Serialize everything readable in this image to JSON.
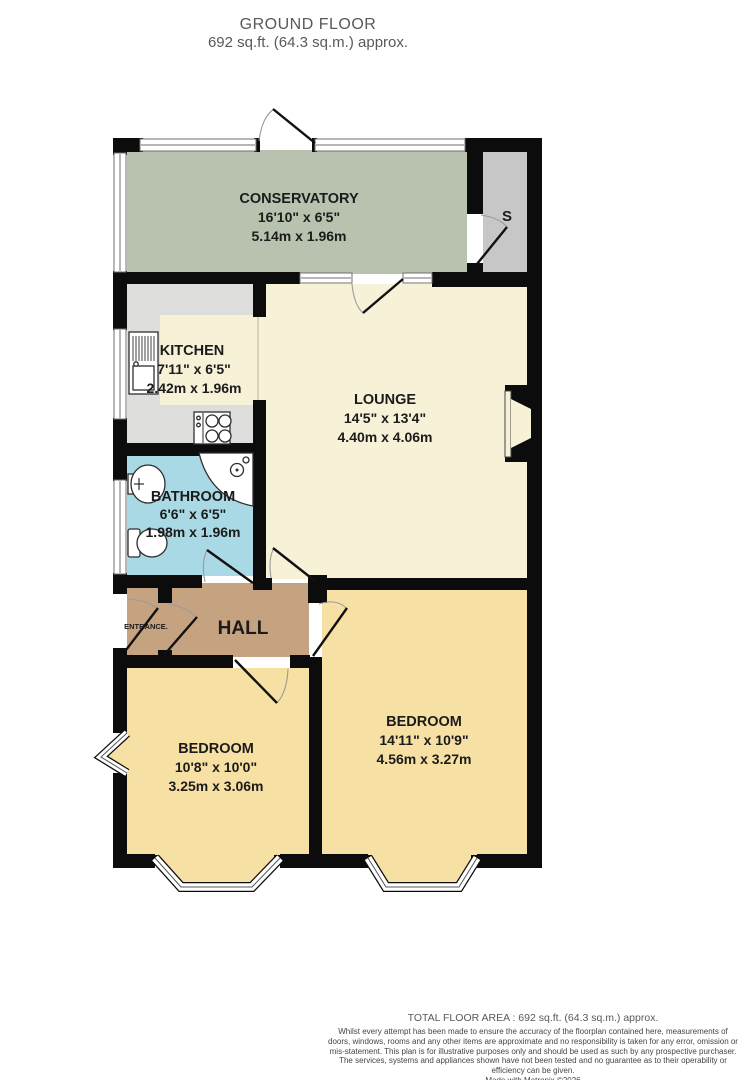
{
  "header": {
    "title": "GROUND FLOOR",
    "subtitle": "692 sq.ft. (64.3 sq.m.) approx."
  },
  "rooms": {
    "conservatory": {
      "name": "CONSERVATORY",
      "imperial": "16'10\" x 6'5\"",
      "metric": "5.14m x 1.96m",
      "color": "#b9c2ae"
    },
    "kitchen": {
      "name": "KITCHEN",
      "imperial": "7'11\" x 6'5\"",
      "metric": "2.42m x 1.96m",
      "color": "#dededd",
      "worktop_color": "#f6f1d7"
    },
    "lounge": {
      "name": "LOUNGE",
      "imperial": "14'5\" x 13'4\"",
      "metric": "4.40m x 4.06m",
      "color": "#f6f1d7"
    },
    "bathroom": {
      "name": "BATHROOM",
      "imperial": "6'6\" x 6'5\"",
      "metric": "1.98m x 1.96m",
      "color": "#aad9e6"
    },
    "hall": {
      "name": "HALL",
      "color": "#c6a380"
    },
    "entrance": {
      "name": "ENTRANCE.",
      "color": "#c6a380"
    },
    "storage": {
      "name": "S",
      "color": "#c7c7c7"
    },
    "bedroom_left": {
      "name": "BEDROOM",
      "imperial": "10'8\" x 10'0\"",
      "metric": "3.25m x 3.06m",
      "color": "#f7e0a3"
    },
    "bedroom_right": {
      "name": "BEDROOM",
      "imperial": "14'11\" x 10'9\"",
      "metric": "4.56m x 3.27m",
      "color": "#f7e0a3"
    }
  },
  "footer": {
    "area_line": "TOTAL FLOOR AREA : 692 sq.ft. (64.3 sq.m.) approx.",
    "disclaimer": "Whilst every attempt has been made to ensure the accuracy of the floorplan contained here, measurements of doors, windows, rooms and any other items are approximate and no responsibility is taken for any error, omission or mis-statement. This plan is for illustrative purposes only and should be used as such by any prospective purchaser. The services, systems and appliances shown have not been tested and no guarantee as to their operability or efficiency can be given.",
    "credit": "Made with Metropix ©2026"
  }
}
